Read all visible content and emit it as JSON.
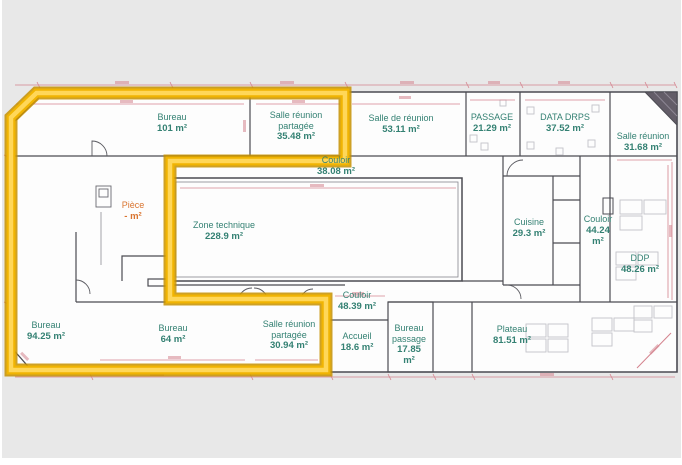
{
  "app": {
    "view": "floor-plan",
    "description": "architectural floor plan with one zone highlighted in yellow"
  },
  "colors": {
    "page_bg": "#ffffff",
    "canvas_bg": "#e8e8e8",
    "plan_fill": "#fdfdfd",
    "wall": "#4b4b52",
    "wall_thin": "#85858c",
    "dimension_pink": "#d4838e",
    "label_green": "#348173",
    "label_orange": "#d9742f",
    "furniture_gray": "#c3c3c8",
    "door_arc": "#5a5a60",
    "hatch_corner": "#635d68",
    "highlight_outer": "#c59100",
    "highlight_mid": "#f0b402",
    "highlight_inner": "#ffd95e"
  },
  "highlight": {
    "name": "selected-zone-outline",
    "path": "M11,117.5 L36.5,93 H345 V161 H170 V299 H326 V370 H11 Z"
  },
  "rooms": [
    {
      "id": "bureau-101",
      "name_lines": [
        "Bureau"
      ],
      "area_lines": [
        "101 m²"
      ],
      "cx": 172,
      "top": 112,
      "style": "green"
    },
    {
      "id": "salle-reunion-partagee-35",
      "name_lines": [
        "Salle réunion",
        "partagée"
      ],
      "area_lines": [
        "35.48 m²"
      ],
      "cx": 296,
      "top": 110,
      "style": "green"
    },
    {
      "id": "salle-de-reunion-53",
      "name_lines": [
        "Salle de réunion"
      ],
      "area_lines": [
        "53.11 m²"
      ],
      "cx": 401,
      "top": 113,
      "style": "green"
    },
    {
      "id": "passage-21",
      "name_lines": [
        "PASSAGE"
      ],
      "area_lines": [
        "21.29 m²"
      ],
      "cx": 492,
      "top": 112,
      "style": "green"
    },
    {
      "id": "data-drps-37",
      "name_lines": [
        "DATA DRPS"
      ],
      "area_lines": [
        "37.52 m²"
      ],
      "cx": 565,
      "top": 112,
      "style": "green"
    },
    {
      "id": "salle-reunion-31",
      "name_lines": [
        "Salle réunion"
      ],
      "area_lines": [
        "31.68 m²"
      ],
      "cx": 643,
      "top": 131,
      "style": "green"
    },
    {
      "id": "couloir-38",
      "name_lines": [
        "Couloir"
      ],
      "area_lines": [
        "38.08 m²"
      ],
      "cx": 336,
      "top": 155,
      "style": "green"
    },
    {
      "id": "piece",
      "name_lines": [
        "Pièce"
      ],
      "area_lines": [
        "- m²"
      ],
      "cx": 133,
      "top": 200,
      "style": "orange"
    },
    {
      "id": "zone-technique-228",
      "name_lines": [
        "Zone technique"
      ],
      "area_lines": [
        "228.9 m²"
      ],
      "cx": 224,
      "top": 220,
      "style": "green"
    },
    {
      "id": "cuisine-29",
      "name_lines": [
        "Cuisine"
      ],
      "area_lines": [
        "29.3 m²"
      ],
      "cx": 529,
      "top": 217,
      "style": "green"
    },
    {
      "id": "couloir-44",
      "name_lines": [
        "Couloir"
      ],
      "area_lines": [
        "44.24",
        "m²"
      ],
      "cx": 598,
      "top": 214,
      "style": "green"
    },
    {
      "id": "ddp-48",
      "name_lines": [
        "DDP"
      ],
      "area_lines": [
        "48.26 m²"
      ],
      "cx": 640,
      "top": 253,
      "style": "green"
    },
    {
      "id": "bureau-94",
      "name_lines": [
        "Bureau"
      ],
      "area_lines": [
        "94.25 m²"
      ],
      "cx": 46,
      "top": 320,
      "style": "green"
    },
    {
      "id": "bureau-64",
      "name_lines": [
        "Bureau"
      ],
      "area_lines": [
        "64 m²"
      ],
      "cx": 173,
      "top": 323,
      "style": "green"
    },
    {
      "id": "salle-reunion-partagee-30",
      "name_lines": [
        "Salle réunion",
        "partagée"
      ],
      "area_lines": [
        "30.94 m²"
      ],
      "cx": 289,
      "top": 319,
      "style": "green"
    },
    {
      "id": "couloir-48",
      "name_lines": [
        "Couloir"
      ],
      "area_lines": [
        "48.39 m²"
      ],
      "cx": 357,
      "top": 290,
      "style": "green"
    },
    {
      "id": "accueil-18",
      "name_lines": [
        "Accueil"
      ],
      "area_lines": [
        "18.6 m²"
      ],
      "cx": 357,
      "top": 331,
      "style": "green"
    },
    {
      "id": "bureau-passage-17",
      "name_lines": [
        "Bureau",
        "passage"
      ],
      "area_lines": [
        "17.85",
        "m²"
      ],
      "cx": 409,
      "top": 323,
      "style": "green"
    },
    {
      "id": "plateau-81",
      "name_lines": [
        "Plateau"
      ],
      "area_lines": [
        "81.51 m²"
      ],
      "cx": 512,
      "top": 324,
      "style": "green"
    }
  ]
}
